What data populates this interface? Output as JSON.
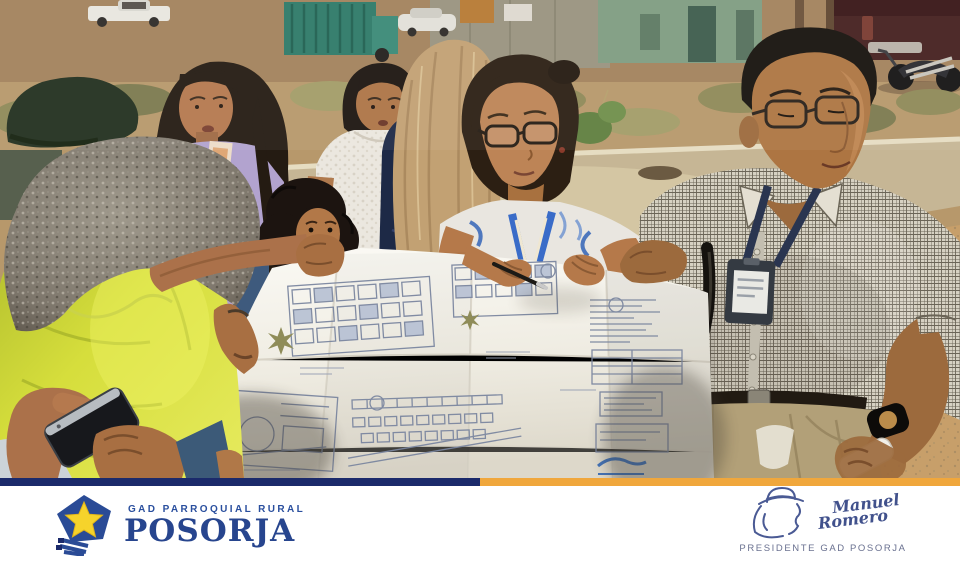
{
  "footer": {
    "brand": {
      "tagline": "GAD PARROQUIAL RURAL",
      "name": "POSORJA"
    },
    "signature": {
      "first_name": "Manuel",
      "last_name": "Romero",
      "title": "PRESIDENTE GAD POSORJA"
    },
    "colors": {
      "bar_navy": "#1b2a6b",
      "bar_yellow": "#f0a73c",
      "logo_blue": "#2a4f9e",
      "star_yellow": "#f6d32b",
      "signature_ink": "#41518c"
    }
  },
  "photo": {
    "caption": "Community members and officials review a large printed urban site plan outdoors on an unpaved street",
    "scene_elements": [
      "man-yellow-tshirt-foreground",
      "hands-holding-smartphone",
      "woman-lavender-tshirt",
      "child-girl",
      "woman-white-blouse",
      "woman-navy-top",
      "woman-blonde-back",
      "woman-glasses-blue-blouse",
      "man-checked-shirt-lanyard",
      "blueprint-site-plan",
      "white-pickup-truck",
      "green-truck",
      "maroon-pickup-truck",
      "motorcycle",
      "dirt-field",
      "concrete-road",
      "dry-shrubs"
    ],
    "palette": {
      "sand": "#c79f6a",
      "road": "#c6b695",
      "yellow_shirt": "#d6de3c",
      "lavender_shirt": "#b2a3cf",
      "paper": "#f6f4ee",
      "plan_ink": "#7b86a0",
      "khaki_pants": "#b2a078"
    }
  }
}
